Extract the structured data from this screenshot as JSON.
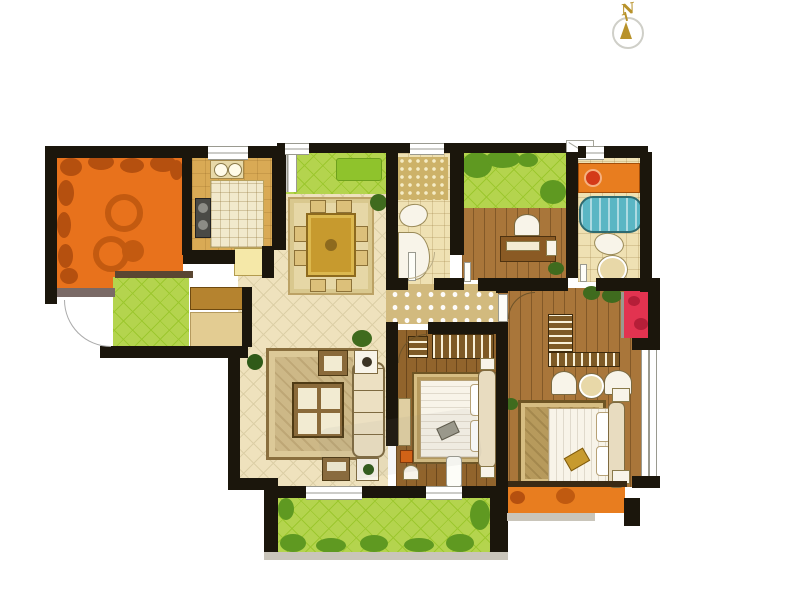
{
  "compass": {
    "label": "N"
  },
  "palette": {
    "wall": "#1b160c",
    "floor": "#efe2bd",
    "floorline": "#dccfa6",
    "kitchen": "#d9aa55",
    "terrace": "#e8721c",
    "terraceleaf": "#b5500f",
    "green": "#b4d44e",
    "greengrid": "#9cc72e",
    "greendark": "#5f9921",
    "wood": "#a9763a",
    "wooddark": "#91642c",
    "bath": "#efe1b3",
    "mosaic": "#d2ba7e",
    "tub": "#5ab6c4",
    "counter": "#e87d1f",
    "red": "#e23350",
    "rug": "#cdb887",
    "gold": "#c79a2e",
    "fixture": "#f8f4e9",
    "sill": "#c9c5ba",
    "compass": "#b8922a"
  }
}
